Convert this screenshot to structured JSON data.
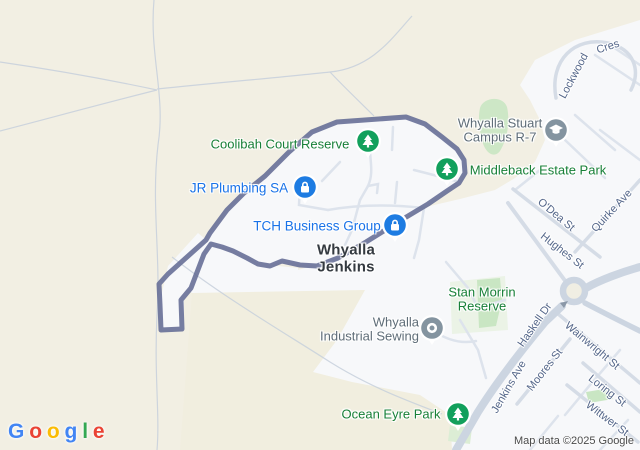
{
  "attribution": "Map data ©2025 Google",
  "logo": {
    "letters": [
      "G",
      "o",
      "o",
      "g",
      "l",
      "e"
    ]
  },
  "city": {
    "name": "Whyalla Jenkins",
    "display": "Whyalla\nJenkins"
  },
  "parks": {
    "coolibah": "Coolibah Court Reserve",
    "middleback": "Middleback Estate Park",
    "stan_morrin": "Stan Morrin\nReserve",
    "ocean_eyre": "Ocean Eyre Park"
  },
  "places": {
    "jr_plumbing": "JR Plumbing SA",
    "tch": "TCH Business Group",
    "campus": "Whyalla Stuart\nCampus R-7",
    "sewing": "Whyalla\nIndustrial Sewing"
  },
  "streets": {
    "lockwood": "Lockwood",
    "lockwood_cres": "Cres",
    "odea": "O'Dea St",
    "quirke": "Quirke Ave",
    "hughes": "Hughes St",
    "haskell": "Haskell Dr",
    "jenkins": "Jenkins Ave",
    "moores": "Moores St",
    "wainwright": "Wainwright St",
    "loring": "Loring St",
    "wittwer": "Wittwer St"
  },
  "icons": {
    "tree_pins": "pine-tree",
    "business_pins": "padlock-bag",
    "school_pin": "graduation-cap",
    "generic_pin": "circle-dot"
  },
  "colors": {
    "terrain": "#f2efe3",
    "urban": "#f7f8fa",
    "road": "#d5dce6",
    "park_fill": "#cbe6c4",
    "boundary": "#676f97",
    "park_label": "#188038",
    "place_label": "#1a73e8",
    "muted_label": "#5f6d78",
    "street_label": "#55678a",
    "pin_green": "#12a05c",
    "pin_blue": "#1e7ce2",
    "pin_gray": "#8494a0"
  }
}
